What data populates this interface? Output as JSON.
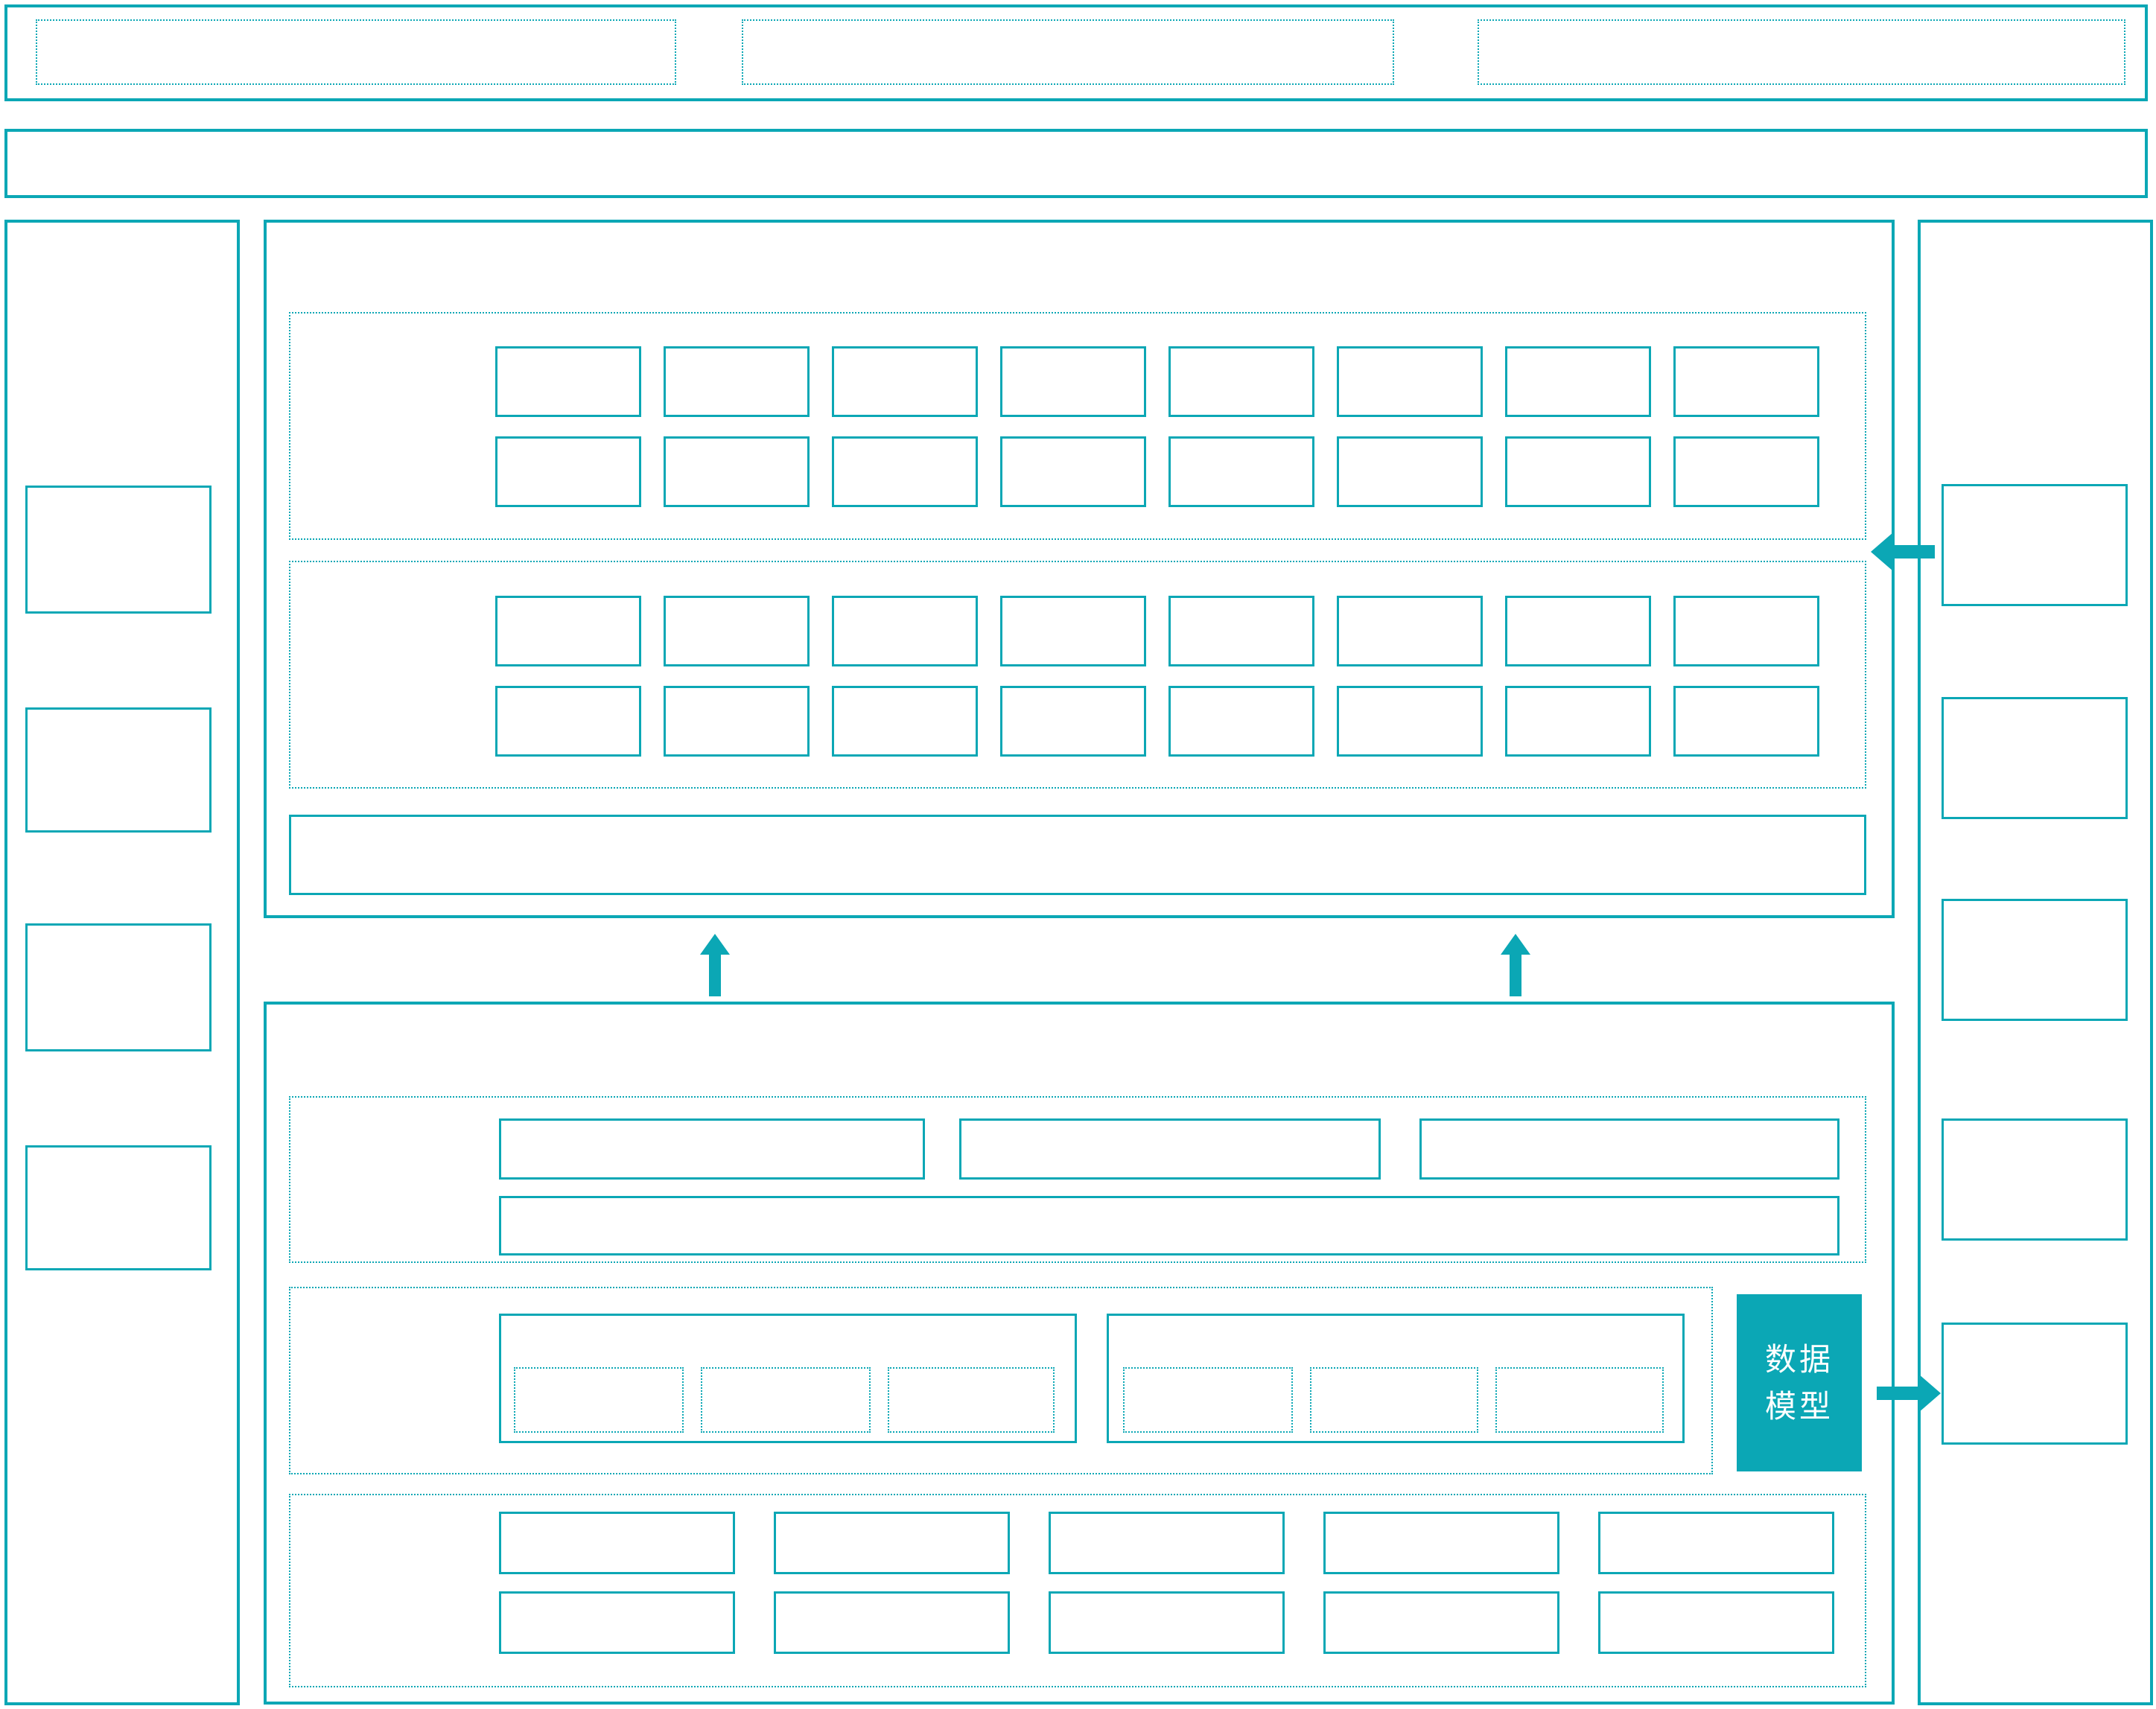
{
  "diagram": {
    "data_model_box": {
      "label": "数据模型",
      "lines": [
        "数据",
        "模型"
      ]
    }
  },
  "colors": {
    "accent": "#0ba7b5",
    "model_box_fill": "#0ba7b5",
    "model_box_text": "#ffffff"
  }
}
